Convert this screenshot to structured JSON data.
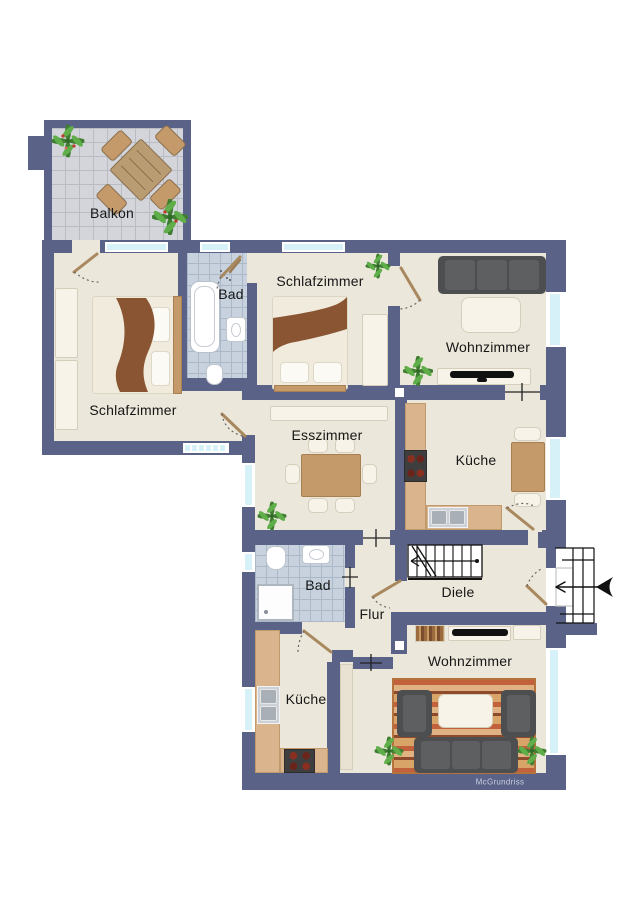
{
  "watermark": "McGrundriss",
  "rooms": {
    "balkon": {
      "label": "Balkon",
      "furniture": [
        "patio-table",
        "patio-chairs",
        "potted-plants"
      ]
    },
    "schlafzimmer_links": {
      "label": "Schlafzimmer",
      "furniture": [
        "double-bed",
        "wardrobes"
      ]
    },
    "bad_oben": {
      "label": "Bad",
      "furniture": [
        "bathtub",
        "wash-basin",
        "toilet",
        "shower-head"
      ]
    },
    "schlafzimmer_oben": {
      "label": "Schlafzimmer",
      "furniture": [
        "double-bed",
        "wardrobe",
        "plant"
      ]
    },
    "wohnzimmer_oben": {
      "label": "Wohnzimmer",
      "furniture": [
        "sofa",
        "coffee-table",
        "tv-sideboard",
        "plant"
      ]
    },
    "esszimmer": {
      "label": "Esszimmer",
      "furniture": [
        "dining-table",
        "chairs",
        "sideboard",
        "plant"
      ]
    },
    "kueche_oben": {
      "label": "Küche",
      "furniture": [
        "l-shaped-counter",
        "stove",
        "sink",
        "table",
        "chairs"
      ]
    },
    "diele": {
      "label": "Diele",
      "furniture": [
        "internal-staircase"
      ]
    },
    "flur": {
      "label": "Flur",
      "furniture": []
    },
    "bad_unten": {
      "label": "Bad",
      "furniture": [
        "shower",
        "toilet",
        "wash-basin"
      ]
    },
    "kueche_unten": {
      "label": "Küche",
      "furniture": [
        "l-shaped-counter",
        "stove",
        "sink"
      ]
    },
    "wohnzimmer_unten": {
      "label": "Wohnzimmer",
      "furniture": [
        "sofa",
        "armchairs",
        "coffee-table",
        "rug",
        "tv-sideboard",
        "plants"
      ]
    }
  },
  "colors": {
    "wall": "#5a6288",
    "floor": "#ece7db",
    "tile_bath": "#c7d2de",
    "tile_balc": "#d3d5da",
    "glass": "#d6f1f8",
    "counter": "#d9b48c",
    "wood": "#c59a6b",
    "sofa": "#4c4e4f",
    "rug": "#d09a5f",
    "blanket": "#8a5532",
    "door_leaf": "#a8885e",
    "plant_a": "#3f7d31",
    "plant_b": "#5fae4a",
    "watermark_color": "#c9cede"
  }
}
